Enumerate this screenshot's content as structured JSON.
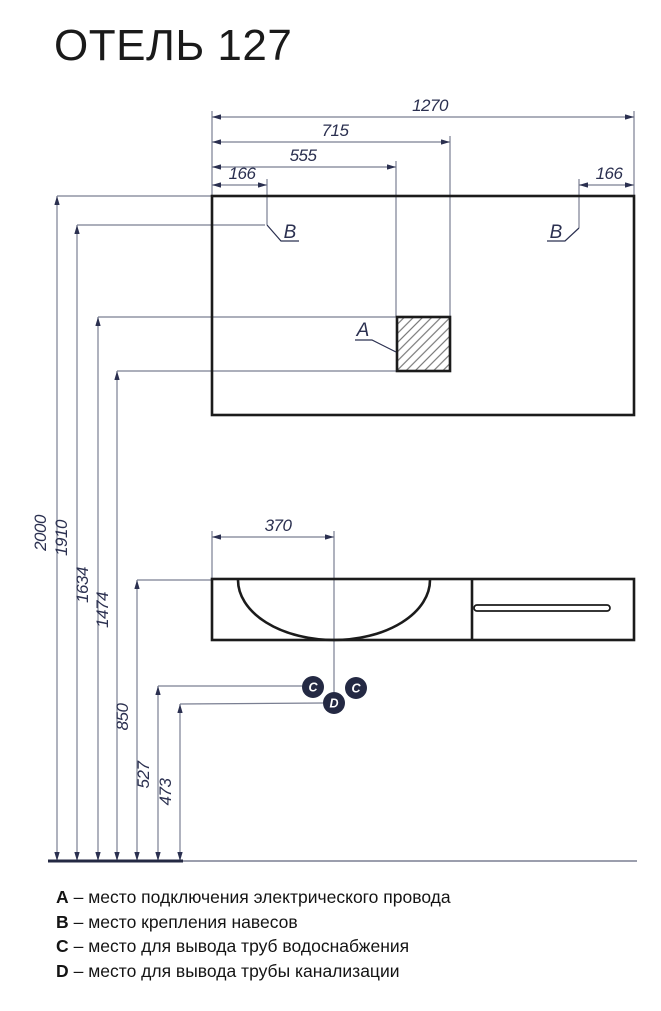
{
  "title": "ОТЕЛЬ 127",
  "dims": {
    "total_width": "1270",
    "socket_right": "715",
    "socket_left": "555",
    "hanger_left": "166",
    "hanger_right": "166",
    "drain_offset": "370",
    "total_height": "2000",
    "hanger_height": "1910",
    "socket_top": "1634",
    "socket_bottom": "1474",
    "basin_height": "850",
    "water_height": "527",
    "drain_height": "473"
  },
  "markers": {
    "socket": "A",
    "hanger_left": "B",
    "hanger_right": "B",
    "water_left": "C",
    "water_right": "C",
    "drain": "D"
  },
  "legend": [
    {
      "key": "A",
      "text": "– место подключения электрического провода"
    },
    {
      "key": "B",
      "text": "– место крепления навесов"
    },
    {
      "key": "C",
      "text": "– место для вывода труб водоснабжения"
    },
    {
      "key": "D",
      "text": "– место для вывода трубы канализации"
    }
  ],
  "colors": {
    "paper": "#ffffff",
    "title_text": "#1a1a1a",
    "drawing_line": "#1b1b1b",
    "dimension_line": "#7a7f92",
    "dimension_text": "#2b3050",
    "arrow": "#2b3050",
    "hatch_line": "#606060",
    "point_fill": "#242943",
    "point_text": "#ffffff",
    "floor_accent": "#242943",
    "legend_text": "#141414"
  }
}
